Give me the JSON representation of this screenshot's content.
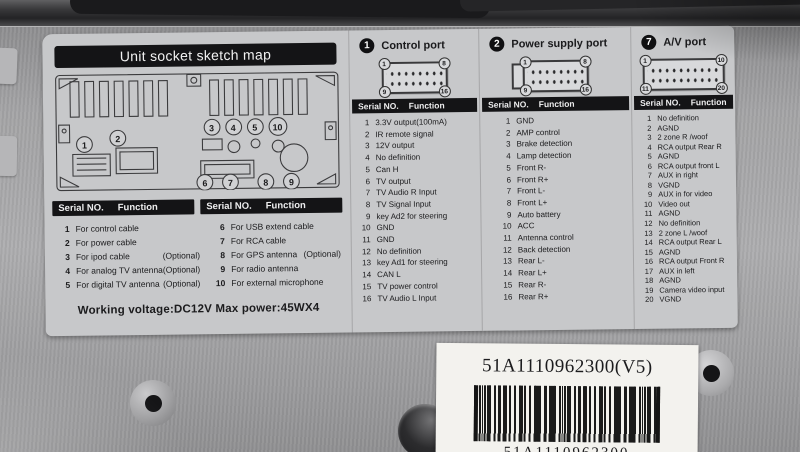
{
  "colors": {
    "sticker_bg": "#c7c8ca",
    "header_bar": "#141416",
    "metal": "#a4a4a6",
    "white_label": "#f3f2ee",
    "text": "#1b1b1d"
  },
  "serial_header": {
    "serial": "Serial NO.",
    "function": "Function"
  },
  "sketch": {
    "title": "Unit socket sketch map",
    "callouts": {
      "c1": "1",
      "c2": "2",
      "c3": "3",
      "c4": "4",
      "c5": "5",
      "c10": "10",
      "c6": "6",
      "c7": "7",
      "c8": "8",
      "c9": "9"
    },
    "table_a": [
      {
        "no": "1",
        "fn": "For control cable",
        "opt": ""
      },
      {
        "no": "2",
        "fn": "For power cable",
        "opt": ""
      },
      {
        "no": "3",
        "fn": "For ipod cable",
        "opt": "(Optional)"
      },
      {
        "no": "4",
        "fn": "For analog TV antenna",
        "opt": "(Optional)"
      },
      {
        "no": "5",
        "fn": "For digital TV antenna",
        "opt": "(Optional)"
      }
    ],
    "table_b": [
      {
        "no": "6",
        "fn": "For USB extend cable",
        "opt": ""
      },
      {
        "no": "7",
        "fn": "For RCA cable",
        "opt": ""
      },
      {
        "no": "8",
        "fn": "For GPS antenna",
        "opt": "(Optional)"
      },
      {
        "no": "9",
        "fn": "For radio antenna",
        "opt": ""
      },
      {
        "no": "10",
        "fn": "For external microphone",
        "opt": ""
      }
    ],
    "footnote": "Working voltage:DC12V  Max power:45WX4"
  },
  "ports": [
    {
      "badge": "1",
      "title": "Control port",
      "corners": [
        "1",
        "8",
        "9",
        "16"
      ],
      "rows": [
        {
          "no": "1",
          "fn": "3.3V output(100mA)"
        },
        {
          "no": "2",
          "fn": "IR remote signal"
        },
        {
          "no": "3",
          "fn": "12V output"
        },
        {
          "no": "4",
          "fn": "No definition"
        },
        {
          "no": "5",
          "fn": "Can H"
        },
        {
          "no": "6",
          "fn": "TV output"
        },
        {
          "no": "7",
          "fn": "TV Audio R Input"
        },
        {
          "no": "8",
          "fn": "TV Signal Input"
        },
        {
          "no": "9",
          "fn": "key Ad2 for steering"
        },
        {
          "no": "10",
          "fn": "GND"
        },
        {
          "no": "11",
          "fn": "GND"
        },
        {
          "no": "12",
          "fn": "No definition"
        },
        {
          "no": "13",
          "fn": "key Ad1 for steering"
        },
        {
          "no": "14",
          "fn": "CAN L"
        },
        {
          "no": "15",
          "fn": "TV power control"
        },
        {
          "no": "16",
          "fn": "TV Audio L Input"
        }
      ]
    },
    {
      "badge": "2",
      "title": "Power supply port",
      "corners": [
        "1",
        "8",
        "9",
        "16"
      ],
      "rows": [
        {
          "no": "1",
          "fn": "GND"
        },
        {
          "no": "2",
          "fn": "AMP control"
        },
        {
          "no": "3",
          "fn": "Brake detection"
        },
        {
          "no": "4",
          "fn": "Lamp detection"
        },
        {
          "no": "5",
          "fn": "Front R-"
        },
        {
          "no": "6",
          "fn": "Front R+"
        },
        {
          "no": "7",
          "fn": "Front L-"
        },
        {
          "no": "8",
          "fn": "Front L+"
        },
        {
          "no": "9",
          "fn": "Auto battery"
        },
        {
          "no": "10",
          "fn": "ACC"
        },
        {
          "no": "11",
          "fn": "Antenna control"
        },
        {
          "no": "12",
          "fn": "Back detection"
        },
        {
          "no": "13",
          "fn": "Rear L-"
        },
        {
          "no": "14",
          "fn": "Rear L+"
        },
        {
          "no": "15",
          "fn": "Rear R-"
        },
        {
          "no": "16",
          "fn": "Rear R+"
        }
      ]
    },
    {
      "badge": "7",
      "title": "A/V port",
      "corners": [
        "1",
        "10",
        "11",
        "20"
      ],
      "rows": [
        {
          "no": "1",
          "fn": "No definition"
        },
        {
          "no": "2",
          "fn": "AGND"
        },
        {
          "no": "3",
          "fn": "2 zone R /woof"
        },
        {
          "no": "4",
          "fn": "RCA output Rear R"
        },
        {
          "no": "5",
          "fn": "AGND"
        },
        {
          "no": "6",
          "fn": "RCA output front L"
        },
        {
          "no": "7",
          "fn": "AUX in right"
        },
        {
          "no": "8",
          "fn": "VGND"
        },
        {
          "no": "9",
          "fn": "AUX in for video"
        },
        {
          "no": "10",
          "fn": "Video out"
        },
        {
          "no": "11",
          "fn": "AGND"
        },
        {
          "no": "12",
          "fn": "No definition"
        },
        {
          "no": "13",
          "fn": "2 zone L /woof"
        },
        {
          "no": "14",
          "fn": "RCA output Rear L"
        },
        {
          "no": "15",
          "fn": "AGND"
        },
        {
          "no": "16",
          "fn": "RCA output Front R"
        },
        {
          "no": "17",
          "fn": "AUX in left"
        },
        {
          "no": "18",
          "fn": "AGND"
        },
        {
          "no": "19",
          "fn": "Camera video input"
        },
        {
          "no": "20",
          "fn": "VGND"
        }
      ]
    }
  ],
  "bottom_label": {
    "part_number": "51A1110962300(V5)",
    "caption_partial": "51A1110962300"
  }
}
